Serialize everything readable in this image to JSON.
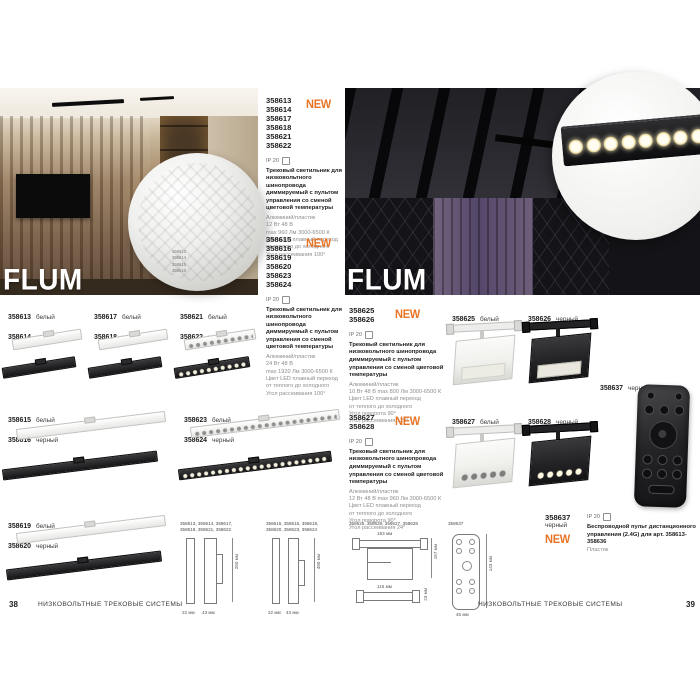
{
  "colors": {
    "new_badge": "#e87425",
    "page_bg": "#ffffff"
  },
  "left": {
    "page_number": "38",
    "footer_text": "НИЗКОВОЛЬТНЫЕ ТРЕКОВЫЕ СИСТЕМЫ",
    "series_title": "FLUM",
    "inset_codes": [
      "358613",
      "358614",
      "358615",
      "358616"
    ],
    "blocks": [
      {
        "codes": [
          "358613",
          "358614",
          "358617",
          "358618",
          "358621",
          "358622"
        ],
        "new": "NEW",
        "ip": "IP 20",
        "title": "Трековый светильник для низковольтного шинопровода диммируемый с пультом управления со сменой цветовой температуры",
        "specs": [
          "Алюминий/пластик",
          "12 Вт  48 В",
          "max 960 Лм  3000-6500 К",
          "Цвет LED плавный переход",
          "от теплого до холодного",
          "Угол рассеивания 100°"
        ]
      },
      {
        "codes": [
          "358615",
          "358616",
          "358619",
          "358620",
          "358623",
          "358624"
        ],
        "new": "NEW",
        "ip": "IP 20",
        "title": "Трековый светильник для низковольтного шинопровода диммируемый с пультом управления со сменой цветовой температуры",
        "specs": [
          "Алюминий/пластик",
          "24 Вт  48 В",
          "max 1920 Лм  3000-6500 К",
          "Цвет LED плавный переход",
          "от теплого до холодного",
          "Угол рассеивания 100°"
        ]
      }
    ],
    "products": [
      {
        "code_a": "358613",
        "color_a": "белый",
        "code_b": "358614",
        "color_b": "черный"
      },
      {
        "code_a": "358617",
        "color_a": "белый",
        "code_b": "358618",
        "color_b": "черный"
      },
      {
        "code_a": "358621",
        "color_a": "белый",
        "code_b": "358622",
        "color_b": "черный"
      },
      {
        "code_a": "358615",
        "color_a": "белый",
        "code_b": "358616",
        "color_b": "черный"
      },
      {
        "code_a": "358623",
        "color_a": "белый",
        "code_b": "358624",
        "color_b": "черный"
      },
      {
        "code_a": "358619",
        "color_a": "белый",
        "code_b": "358620",
        "color_b": "черный"
      }
    ],
    "dim_groups": [
      {
        "header": "358613, 358614, 358617,",
        "header2": "358618, 358621, 358622",
        "h": "250 мм",
        "w1": "22 мм",
        "w2": "43 мм"
      },
      {
        "header": "358615, 358616, 358619,",
        "header2": "358620, 358623, 358624",
        "h": "490 мм",
        "w1": "22 мм",
        "w2": "43 мм"
      }
    ]
  },
  "right": {
    "page_number": "39",
    "footer_text": "НИЗКОВОЛЬТНЫЕ ТРЕКОВЫЕ СИСТЕМЫ",
    "series_title": "FLUM",
    "blocks": [
      {
        "codes": [
          "358625",
          "358626"
        ],
        "new": "NEW",
        "ip": "IP 20",
        "title": "Трековый светильник для низковольтного шинопровода диммируемый с пультом управления со сменой цветовой температуры",
        "specs": [
          "Алюминий/пластик",
          "10 Вт  48 В   max 800 Лм   3000-6500 К",
          "Цвет LED плавный переход",
          "от теплого до холодного",
          "Угол поворота 90°",
          "Угол рассеивания 120°"
        ]
      },
      {
        "codes": [
          "358627",
          "358628"
        ],
        "new": "NEW",
        "ip": "IP 20",
        "title": "Трековый светильник для низковольтного шинопровода диммируемый с пультом управления со сменой цветовой температуры",
        "specs": [
          "Алюминий/пластик",
          "12 Вт  48 В   max 960 Лм   3000-6500 К",
          "Цвет LED плавный переход",
          "от теплого до холодного",
          "Угол поворота 90°",
          "Угол рассеивания 24°"
        ]
      }
    ],
    "products": [
      {
        "code": "358625",
        "color": "белый"
      },
      {
        "code": "358626",
        "color": "черный"
      },
      {
        "code": "358627",
        "color": "белый"
      },
      {
        "code": "358628",
        "color": "черный"
      },
      {
        "code": "358637",
        "color": "черный"
      }
    ],
    "remote_block": {
      "code": "358637",
      "color": "черный",
      "new": "NEW",
      "ip": "IP 20",
      "title": "Беспроводной пульт дистанционного управления (2.4G) для арт. 358613-358636",
      "specs": [
        "Пластик"
      ]
    },
    "dim_groups": [
      {
        "header": "358625, 358626, 358627, 358628",
        "w_top": "183 мм",
        "h_right": "157 мм",
        "w_mid": "115 мм",
        "h_small": "23 мм"
      },
      {
        "header": "358637",
        "h": "143 мм",
        "w": "45 мм"
      }
    ]
  }
}
